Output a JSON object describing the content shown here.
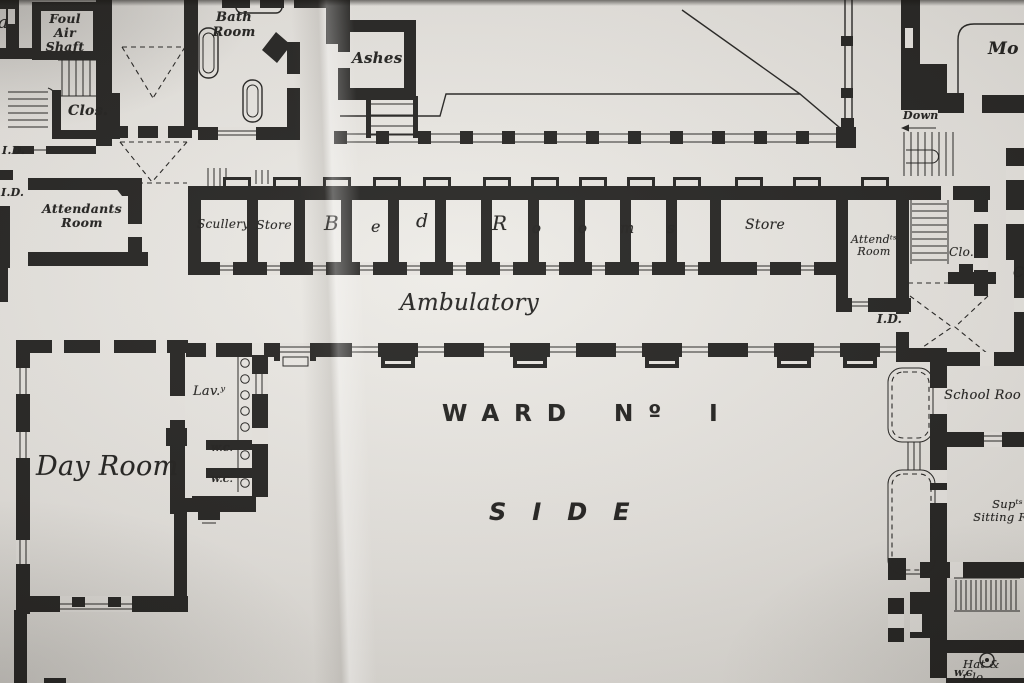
{
  "colors": {
    "paper": "#e7e4df",
    "ink": "#1c1b19"
  },
  "title": {
    "ward": "WARD Nº I",
    "side": "SIDE"
  },
  "rooms": {
    "foul_air_shaft": "Foul\nAir\nShaft",
    "closet_upper": "Clos.",
    "attendants_room_west": "Attendants\nRoom",
    "bath_room": "Bath\nRoom",
    "ashes": "Ashes",
    "scullery": "Scullery",
    "store_west": "Store",
    "store_east": "Store",
    "attendants_room_east": "Attendᵗˢ\nRoom",
    "closet_east": "Clo.",
    "ambulatory": "Ambulatory",
    "lavatory": "Lav.ʸ",
    "wc_upper": "W.C.",
    "wc_lower": "W.C.",
    "day_room": "Day Room",
    "school_room": "School Roo",
    "supt_sitting_room": "Supᵗˢ\nSitting Roo",
    "hat_and_cloak": "Hat & Clo",
    "wc_bottom": "W.C",
    "mortuary_clipped": "Mo"
  },
  "bed_rooms": {
    "word": "Bed Rooms",
    "letters": [
      "B",
      "e",
      "d",
      "R",
      "o",
      "o",
      "m",
      "s"
    ]
  },
  "annotations": {
    "id": [
      "I.D.",
      "I.D.",
      "I.D."
    ],
    "down": "Down",
    "edge_fragment_left": "a",
    "edge_fragment_right": "C"
  }
}
